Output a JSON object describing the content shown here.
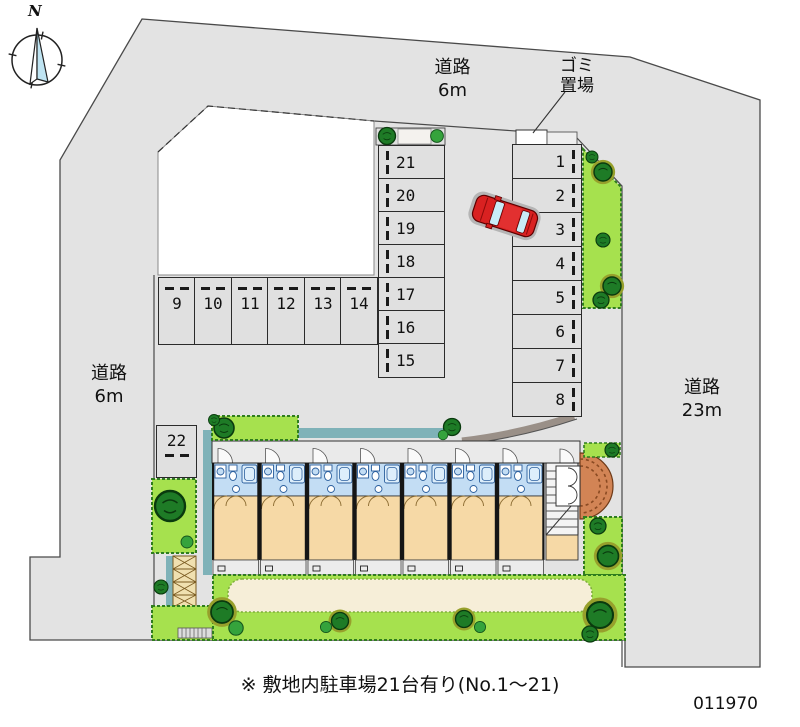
{
  "compass": {
    "label": "N"
  },
  "roads": {
    "top": {
      "name": "道路",
      "size": "6m"
    },
    "left": {
      "name": "道路",
      "size": "6m"
    },
    "right": {
      "name": "道路",
      "size": "23m"
    }
  },
  "garbage": {
    "line1": "ゴミ",
    "line2": "置場"
  },
  "parking": {
    "spots": [
      "1",
      "2",
      "3",
      "4",
      "5",
      "6",
      "7",
      "8",
      "9",
      "10",
      "11",
      "12",
      "13",
      "14",
      "15",
      "16",
      "17",
      "18",
      "19",
      "20",
      "21",
      "22"
    ]
  },
  "footer": {
    "note": "※ 敷地内駐車場21台有り(No.1～21)",
    "plan_number": "011970"
  },
  "colors": {
    "road": "#e3e3e3",
    "stall": "#e0e0e0",
    "green": "#a6e14e",
    "tree": "#1e7b26",
    "room": "#f6d9a6",
    "bath": "#c3ddf4",
    "balcony": "#ececec",
    "teal": "#7fb2b8",
    "brick": "#d28455",
    "sand": "#f6eed8",
    "car": "#d92121"
  }
}
